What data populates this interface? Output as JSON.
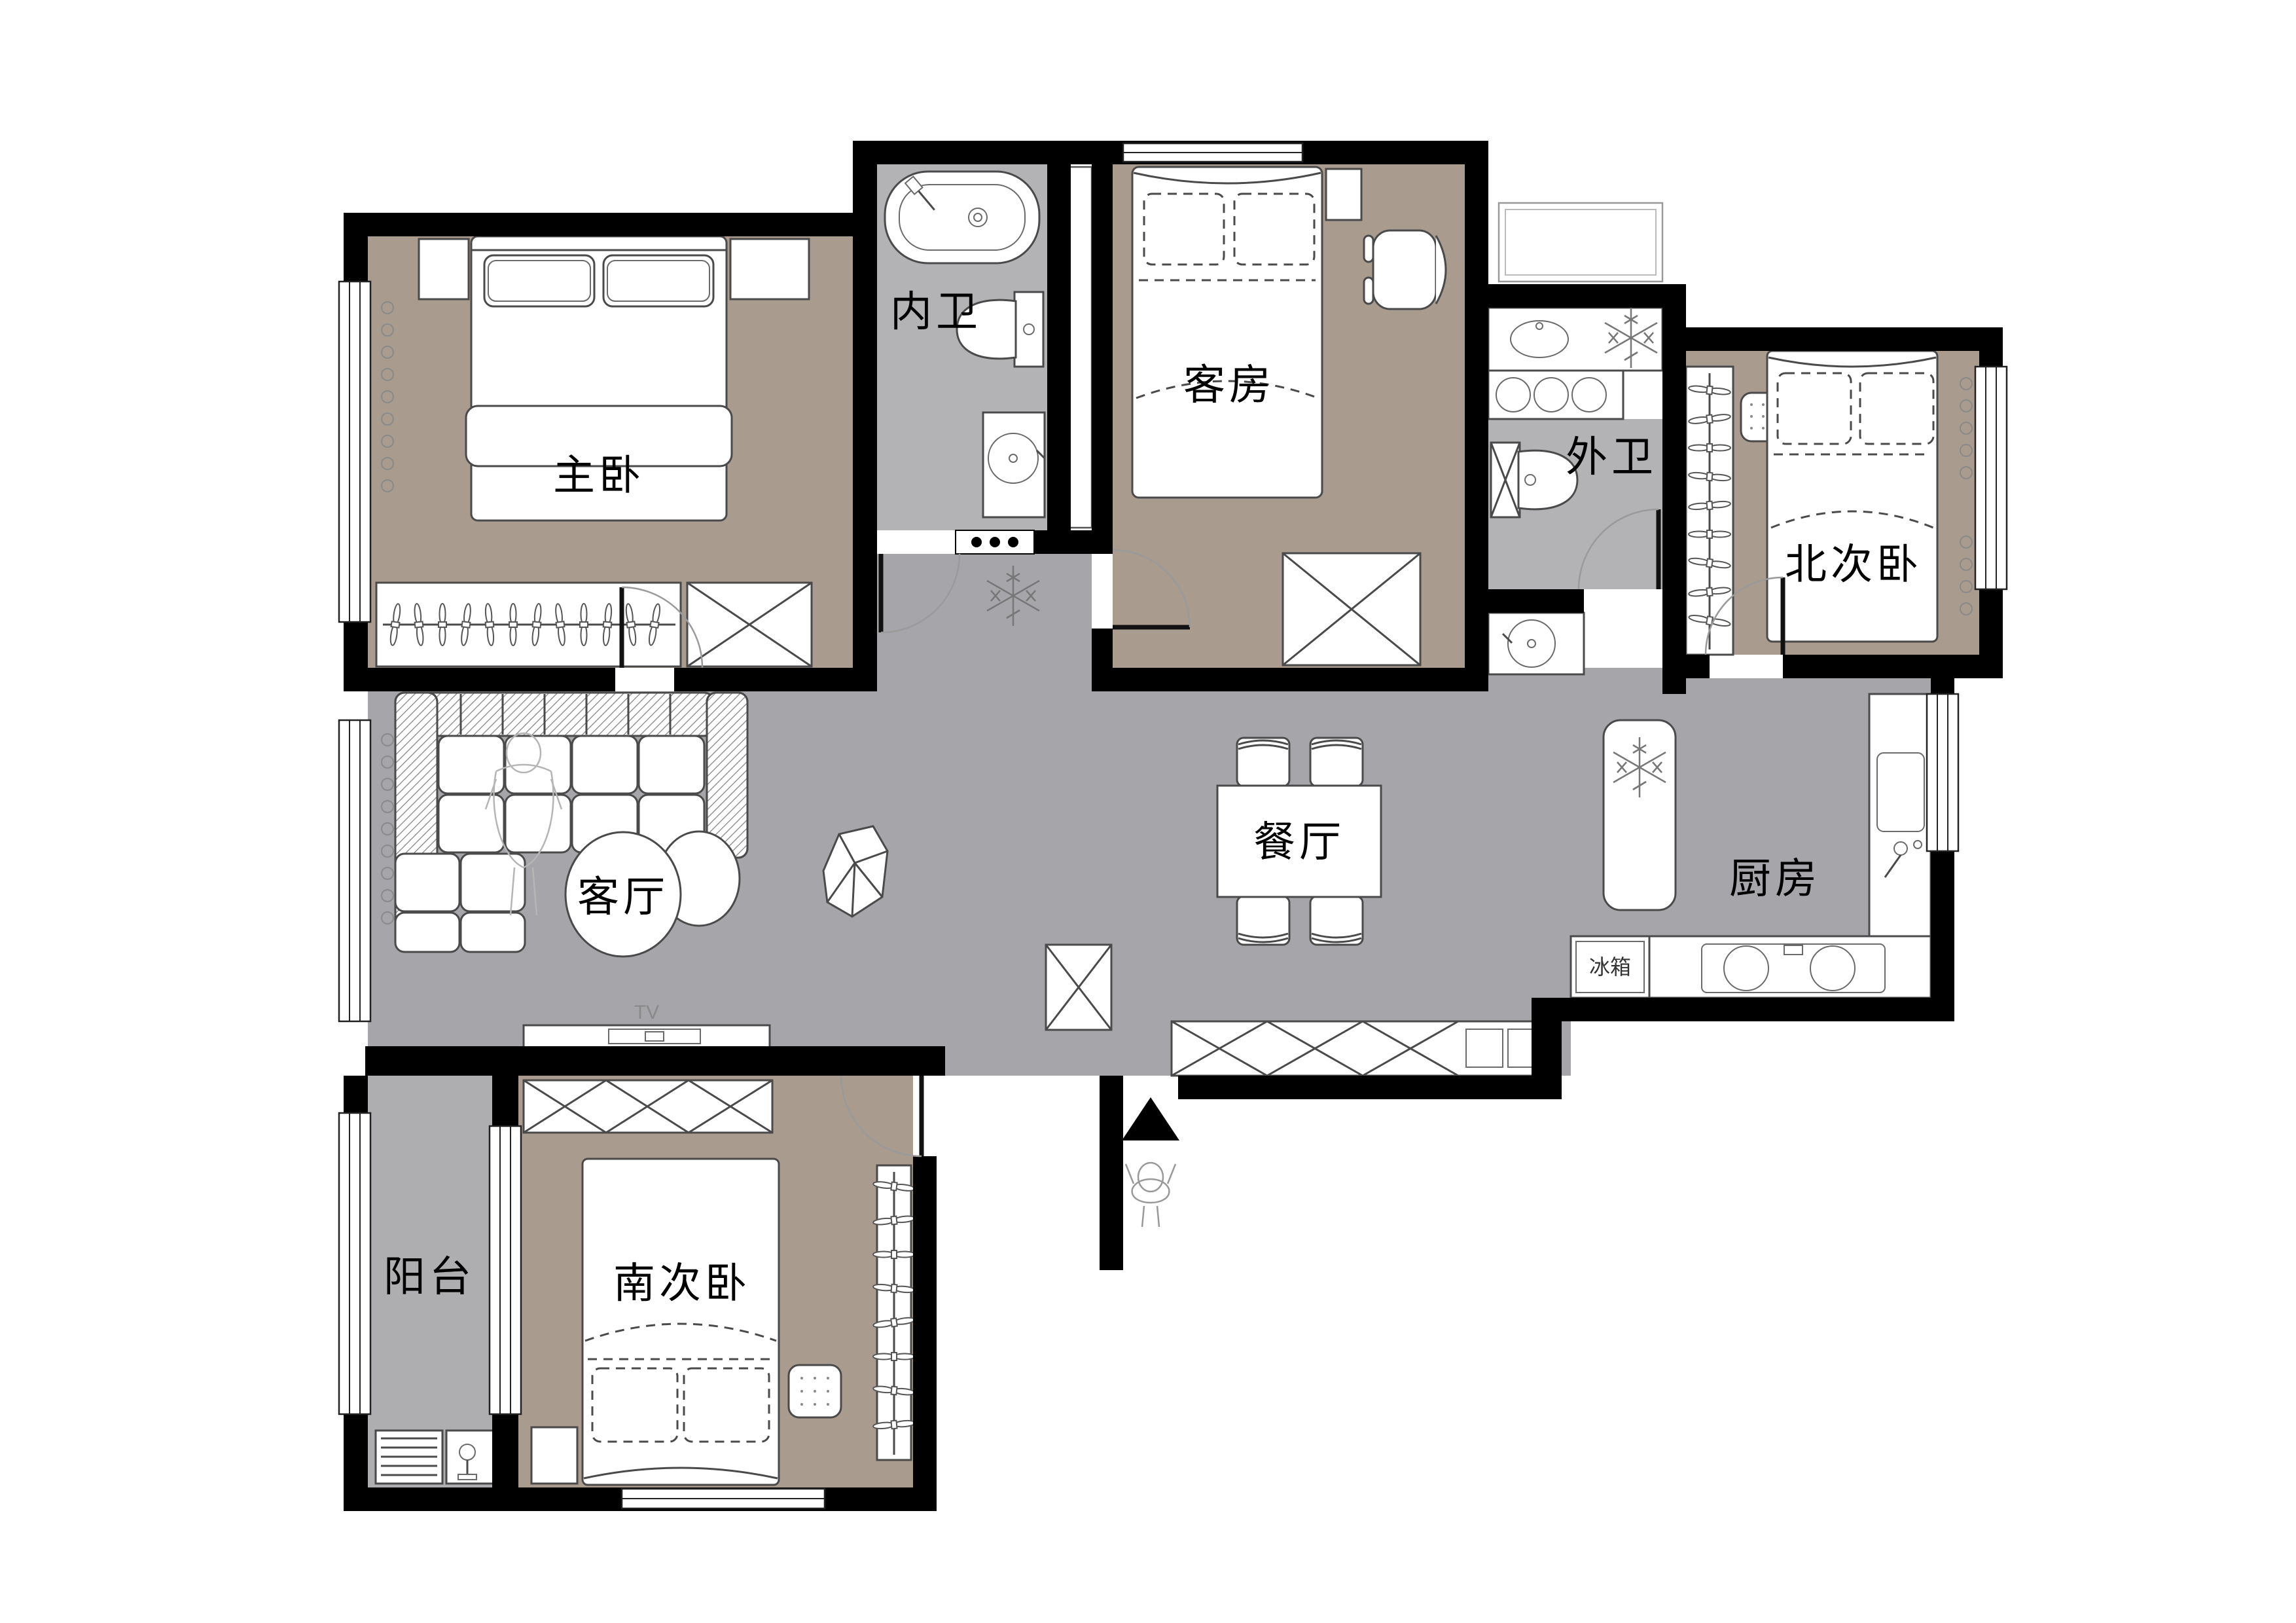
{
  "title": "三室两厅户型图",
  "colors": {
    "wall": "#000000",
    "floor_bedroom": "#a99b8d",
    "floor_public": "#a6a6aa",
    "floor_bath": "#b3b3b5",
    "floor_balcony": "#aeaeb0",
    "furniture_outline": "#4a4a4a"
  },
  "rooms": {
    "master": {
      "label": "主卧"
    },
    "inner_bath": {
      "label": "内卫"
    },
    "guest": {
      "label": "客房"
    },
    "outer_bath": {
      "label": "外卫"
    },
    "north_bed": {
      "label": "北次卧"
    },
    "dining": {
      "label": "餐厅"
    },
    "kitchen": {
      "label": "厨房"
    },
    "living": {
      "label": "客厅"
    },
    "balcony": {
      "label": "阳台"
    },
    "south_bed": {
      "label": "南次卧"
    }
  },
  "appliances": {
    "fridge": {
      "label": "冰箱"
    },
    "tv": {
      "label": "TV"
    }
  }
}
